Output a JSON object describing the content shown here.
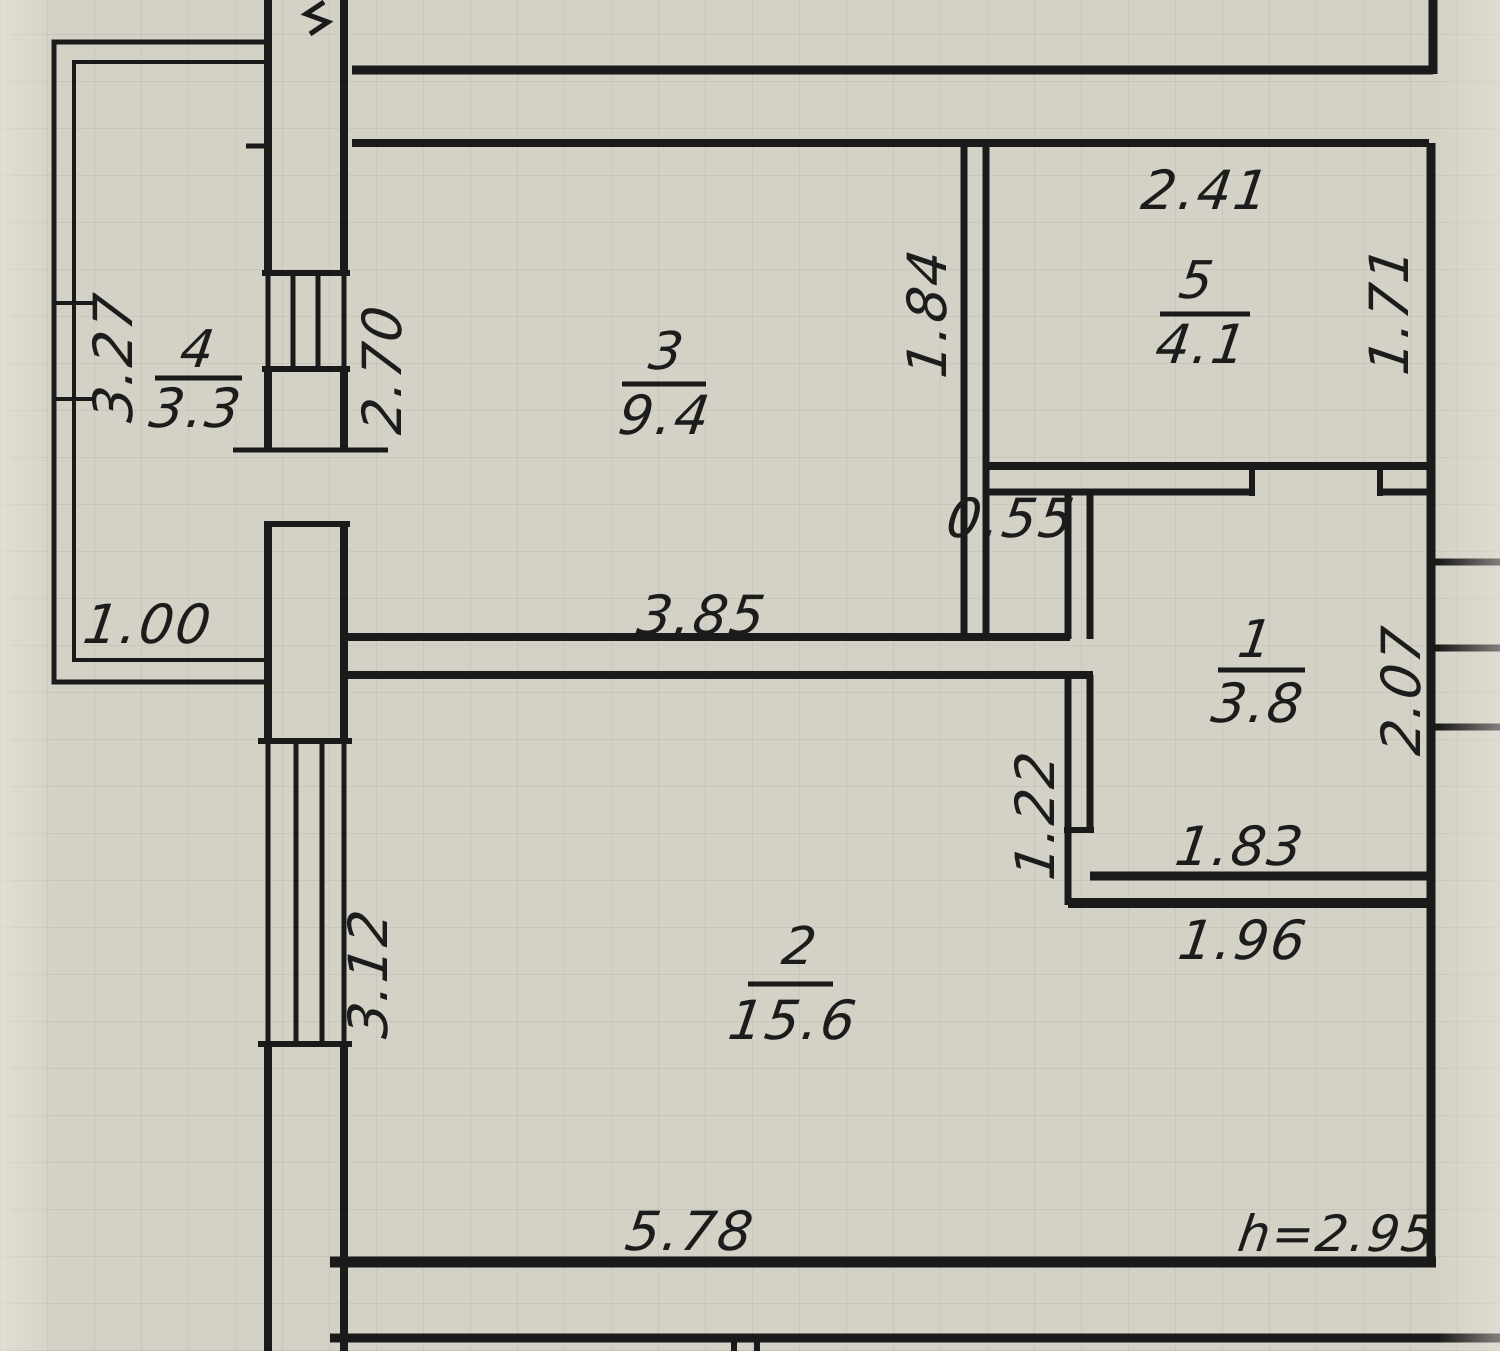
{
  "plan": {
    "ceiling_height_label": "h=2.95",
    "rooms": {
      "room1": {
        "number": "1",
        "area": "3.8"
      },
      "room2": {
        "number": "2",
        "area": "15.6"
      },
      "room3": {
        "number": "3",
        "area": "9.4"
      },
      "room4": {
        "number": "4",
        "area": "3.3"
      },
      "room5": {
        "number": "5",
        "area": "4.1"
      }
    },
    "dimensions": {
      "balcony_height": "3.27",
      "balcony_width": "1.00",
      "room3_left_height": "2.70",
      "room3_width": "3.85",
      "partition_height": "1.84",
      "room5_width": "2.41",
      "room5_height": "1.71",
      "niche_width": "0.55",
      "room1_height": "2.07",
      "room1_width": "1.83",
      "room1_wall_jog": "1.22",
      "room1_bottom_width": "1.96",
      "room2_height": "3.12",
      "room2_width": "5.78"
    }
  }
}
